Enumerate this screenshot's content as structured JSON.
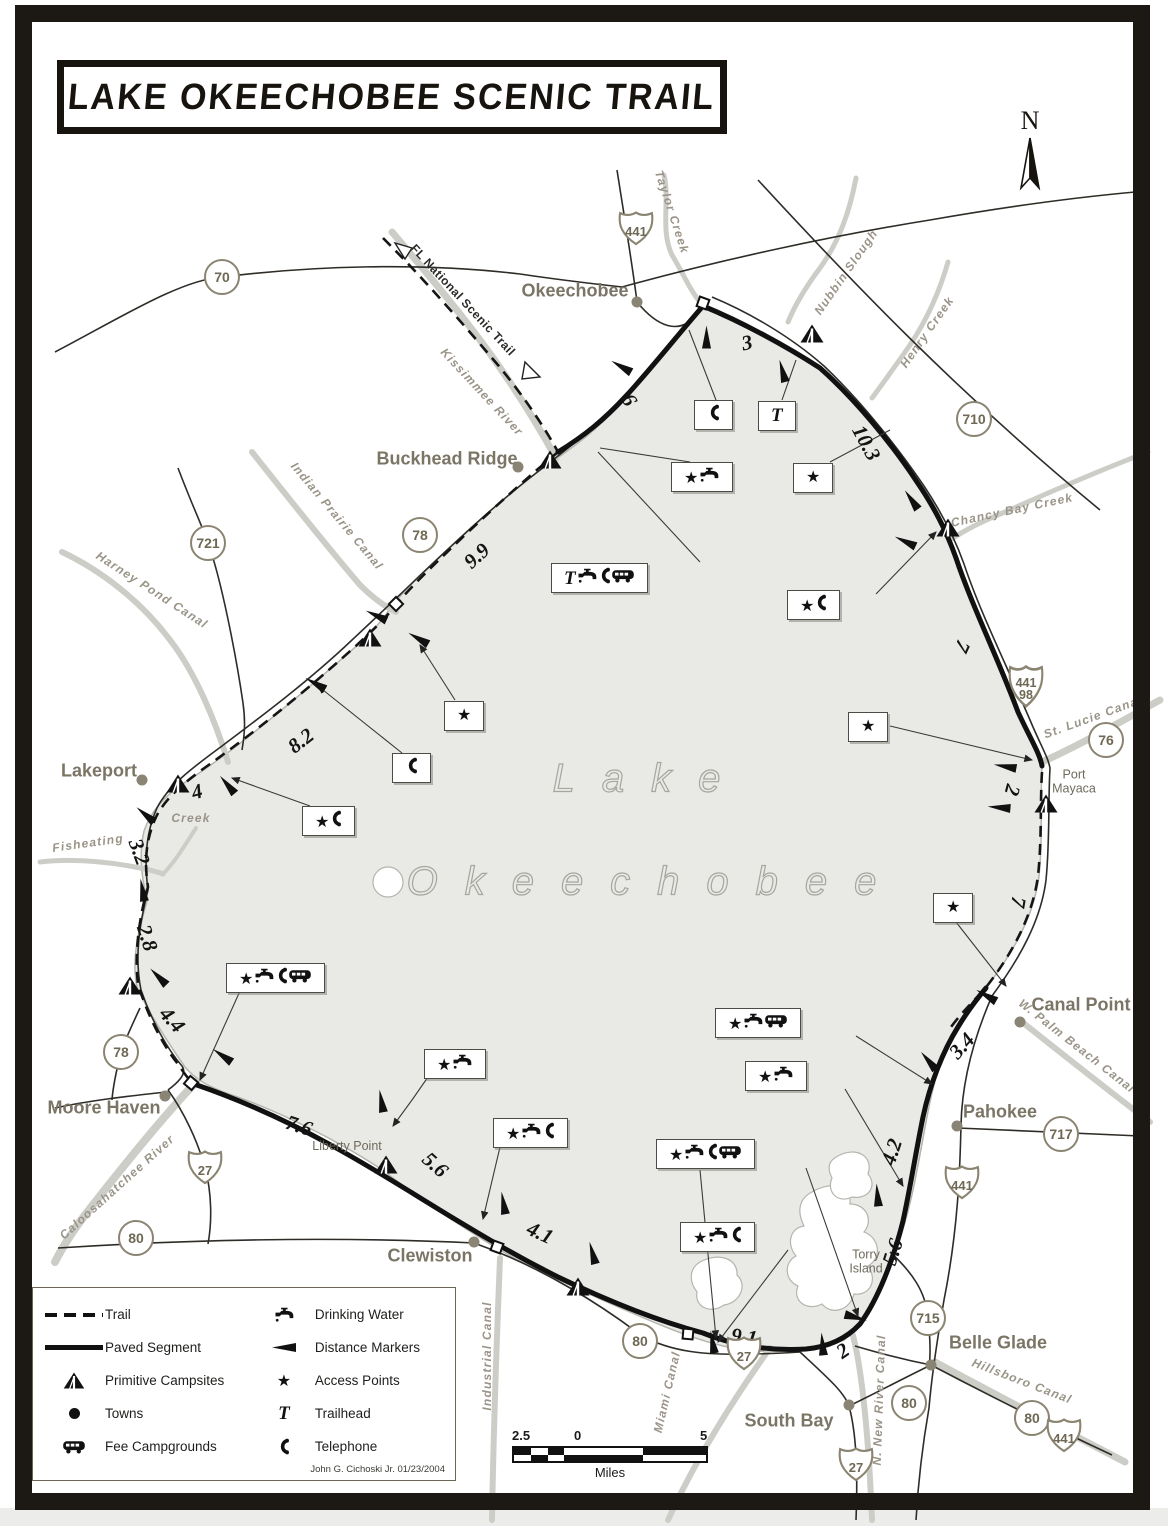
{
  "title": "LAKE OKEECHOBEE SCENIC TRAIL",
  "north": {
    "label": "N"
  },
  "lake": {
    "line1": "Lake",
    "line2": "Okeechobee"
  },
  "fnst": {
    "label": "FL National Scenic Trail"
  },
  "credit": "John G. Cichoski Jr.  01/23/2004",
  "towns": [
    {
      "name": "Okeechobee",
      "x": 575,
      "y": 291
    },
    {
      "name": "Buckhead Ridge",
      "x": 447,
      "y": 459
    },
    {
      "name": "Lakeport",
      "x": 99,
      "y": 771
    },
    {
      "name": "Moore Haven",
      "x": 104,
      "y": 1108
    },
    {
      "name": "Clewiston",
      "x": 430,
      "y": 1256
    },
    {
      "name": "South Bay",
      "x": 789,
      "y": 1421
    },
    {
      "name": "Belle Glade",
      "x": 998,
      "y": 1343
    },
    {
      "name": "Pahokee",
      "x": 1000,
      "y": 1112
    },
    {
      "name": "Canal Point",
      "x": 1081,
      "y": 1005
    }
  ],
  "town_dots": [
    {
      "x": 637,
      "y": 302
    },
    {
      "x": 518,
      "y": 467
    },
    {
      "x": 142,
      "y": 780
    },
    {
      "x": 165,
      "y": 1096
    },
    {
      "x": 474,
      "y": 1242
    },
    {
      "x": 849,
      "y": 1405
    },
    {
      "x": 931,
      "y": 1365
    },
    {
      "x": 957,
      "y": 1126
    },
    {
      "x": 1020,
      "y": 1022
    }
  ],
  "places": [
    {
      "name": "Liberty Point",
      "x": 347,
      "y": 1146
    },
    {
      "name": "Torry\nIsland",
      "x": 866,
      "y": 1262
    },
    {
      "name": "Port\nMayaca",
      "x": 1074,
      "y": 782
    }
  ],
  "circle_shields": [
    {
      "num": "70",
      "x": 222,
      "y": 277
    },
    {
      "num": "721",
      "x": 208,
      "y": 543
    },
    {
      "num": "78",
      "x": 420,
      "y": 535
    },
    {
      "num": "710",
      "x": 974,
      "y": 419
    },
    {
      "num": "76",
      "x": 1106,
      "y": 740
    },
    {
      "num": "717",
      "x": 1061,
      "y": 1134
    },
    {
      "num": "78",
      "x": 121,
      "y": 1052
    },
    {
      "num": "80",
      "x": 136,
      "y": 1238
    },
    {
      "num": "80",
      "x": 640,
      "y": 1341
    },
    {
      "num": "715",
      "x": 928,
      "y": 1318
    },
    {
      "num": "80",
      "x": 909,
      "y": 1403
    },
    {
      "num": "80",
      "x": 1032,
      "y": 1418
    }
  ],
  "us_shields": [
    {
      "num": "441",
      "x": 636,
      "y": 228
    },
    {
      "num": "441\n98",
      "x": 1026,
      "y": 686,
      "cls": "tall"
    },
    {
      "num": "27",
      "x": 205,
      "y": 1167
    },
    {
      "num": "27",
      "x": 744,
      "y": 1353
    },
    {
      "num": "27",
      "x": 856,
      "y": 1464
    },
    {
      "num": "441",
      "x": 962,
      "y": 1182
    },
    {
      "num": "441",
      "x": 1064,
      "y": 1435
    }
  ],
  "water_labels": [
    {
      "name": "Taylor Creek",
      "x": 672,
      "y": 212,
      "rot": 72
    },
    {
      "name": "Kissimmee River",
      "x": 482,
      "y": 392,
      "rot": 47
    },
    {
      "name": "Nubbin Slough",
      "x": 846,
      "y": 272,
      "rot": -55
    },
    {
      "name": "Henry Creek",
      "x": 927,
      "y": 332,
      "rot": -55
    },
    {
      "name": "Chancy Bay Creek",
      "x": 1012,
      "y": 510,
      "rot": -12
    },
    {
      "name": "St. Lucie Canal",
      "x": 1093,
      "y": 717,
      "rot": -20
    },
    {
      "name": "Indian Prairie Canal",
      "x": 337,
      "y": 516,
      "rot": 50
    },
    {
      "name": "Harney Pond Canal",
      "x": 152,
      "y": 590,
      "rot": 33
    },
    {
      "name": "Fisheating",
      "x": 88,
      "y": 843,
      "rot": -8
    },
    {
      "name": "Creek",
      "x": 191,
      "y": 818,
      "rot": 0
    },
    {
      "name": "Caloosahatchee River",
      "x": 117,
      "y": 1187,
      "rot": -42
    },
    {
      "name": "Industrial Canal",
      "x": 487,
      "y": 1356,
      "rot": -90
    },
    {
      "name": "Miami Canal",
      "x": 667,
      "y": 1392,
      "rot": -77
    },
    {
      "name": "N. New River Canal",
      "x": 879,
      "y": 1400,
      "rot": -88
    },
    {
      "name": "Hillsboro Canal",
      "x": 1022,
      "y": 1381,
      "rot": 21
    },
    {
      "name": "W. Palm Beach Canal",
      "x": 1077,
      "y": 1046,
      "rot": 38
    }
  ],
  "distances": [
    {
      "value": "3",
      "x": 747,
      "y": 343,
      "rot": -12
    },
    {
      "value": "6",
      "x": 629,
      "y": 400,
      "rot": 60
    },
    {
      "value": "10.3",
      "x": 866,
      "y": 443,
      "rot": 62
    },
    {
      "value": "9.9",
      "x": 477,
      "y": 556,
      "rot": -42
    },
    {
      "value": "7",
      "x": 962,
      "y": 646,
      "rot": 115
    },
    {
      "value": "8.2",
      "x": 301,
      "y": 741,
      "rot": -38
    },
    {
      "value": "4",
      "x": 197,
      "y": 792,
      "rot": -15
    },
    {
      "value": "3.2",
      "x": 139,
      "y": 852,
      "rot": 70
    },
    {
      "value": "2.8",
      "x": 147,
      "y": 938,
      "rot": 72
    },
    {
      "value": "4.4",
      "x": 172,
      "y": 1020,
      "rot": 48
    },
    {
      "value": "7.6",
      "x": 299,
      "y": 1126,
      "rot": 18
    },
    {
      "value": "5.6",
      "x": 435,
      "y": 1165,
      "rot": 42
    },
    {
      "value": "4.1",
      "x": 540,
      "y": 1233,
      "rot": 25
    },
    {
      "value": "9.1",
      "x": 744,
      "y": 1337,
      "rot": 8
    },
    {
      "value": "2",
      "x": 843,
      "y": 1351,
      "rot": -35
    },
    {
      "value": "5.6",
      "x": 893,
      "y": 1252,
      "rot": -72
    },
    {
      "value": "4.2",
      "x": 892,
      "y": 1152,
      "rot": -72
    },
    {
      "value": "3.4",
      "x": 962,
      "y": 1046,
      "rot": -48
    },
    {
      "value": "7",
      "x": 1018,
      "y": 902,
      "rot": 100
    },
    {
      "value": "2",
      "x": 1012,
      "y": 790,
      "rot": 105
    }
  ],
  "amenity_boxes": [
    {
      "x": 694,
      "y": 400,
      "icons": [
        "phone"
      ]
    },
    {
      "x": 758,
      "y": 401,
      "icons": [
        "trailhead"
      ]
    },
    {
      "x": 671,
      "y": 462,
      "icons": [
        "star",
        "water"
      ]
    },
    {
      "x": 793,
      "y": 463,
      "icons": [
        "star"
      ]
    },
    {
      "x": 551,
      "y": 563,
      "icons": [
        "trailhead",
        "water",
        "phone",
        "fee"
      ]
    },
    {
      "x": 787,
      "y": 590,
      "icons": [
        "star",
        "phone"
      ]
    },
    {
      "x": 444,
      "y": 701,
      "icons": [
        "star"
      ]
    },
    {
      "x": 392,
      "y": 753,
      "icons": [
        "phone"
      ]
    },
    {
      "x": 302,
      "y": 806,
      "icons": [
        "star",
        "phone"
      ]
    },
    {
      "x": 848,
      "y": 712,
      "icons": [
        "star"
      ]
    },
    {
      "x": 933,
      "y": 893,
      "icons": [
        "star"
      ]
    },
    {
      "x": 226,
      "y": 963,
      "icons": [
        "star",
        "water",
        "phone",
        "fee"
      ]
    },
    {
      "x": 715,
      "y": 1008,
      "icons": [
        "star",
        "water",
        "fee"
      ]
    },
    {
      "x": 745,
      "y": 1061,
      "icons": [
        "star",
        "water"
      ]
    },
    {
      "x": 424,
      "y": 1049,
      "icons": [
        "star",
        "water"
      ]
    },
    {
      "x": 493,
      "y": 1118,
      "icons": [
        "star",
        "water",
        "phone"
      ]
    },
    {
      "x": 656,
      "y": 1139,
      "icons": [
        "star",
        "water",
        "phone",
        "fee"
      ]
    },
    {
      "x": 680,
      "y": 1222,
      "icons": [
        "star",
        "water",
        "phone"
      ]
    }
  ],
  "campsites": [
    {
      "x": 812,
      "y": 336
    },
    {
      "x": 550,
      "y": 462
    },
    {
      "x": 370,
      "y": 640
    },
    {
      "x": 178,
      "y": 786
    },
    {
      "x": 130,
      "y": 988
    },
    {
      "x": 948,
      "y": 530
    },
    {
      "x": 1046,
      "y": 806
    },
    {
      "x": 386,
      "y": 1167
    },
    {
      "x": 578,
      "y": 1289
    }
  ],
  "markers": [
    {
      "x": 706,
      "y": 337,
      "rot": 90
    },
    {
      "x": 782,
      "y": 371,
      "rot": 75
    },
    {
      "x": 621,
      "y": 367,
      "rot": 30
    },
    {
      "x": 911,
      "y": 500,
      "rot": 55
    },
    {
      "x": 376,
      "y": 616,
      "rot": 25
    },
    {
      "x": 418,
      "y": 639,
      "rot": 30
    },
    {
      "x": 315,
      "y": 684,
      "rot": 30
    },
    {
      "x": 227,
      "y": 785,
      "rot": 50
    },
    {
      "x": 145,
      "y": 815,
      "rot": 40
    },
    {
      "x": 142,
      "y": 890,
      "rot": 80
    },
    {
      "x": 158,
      "y": 977,
      "rot": 45
    },
    {
      "x": 222,
      "y": 1056,
      "rot": 35
    },
    {
      "x": 381,
      "y": 1101,
      "rot": 80
    },
    {
      "x": 503,
      "y": 1203,
      "rot": 80
    },
    {
      "x": 592,
      "y": 1253,
      "rot": 75
    },
    {
      "x": 822,
      "y": 1344,
      "rot": 85
    },
    {
      "x": 856,
      "y": 1317,
      "rot": 195
    },
    {
      "x": 928,
      "y": 1061,
      "rot": 50
    },
    {
      "x": 877,
      "y": 1195,
      "rot": 85
    },
    {
      "x": 1005,
      "y": 767,
      "rot": 10
    },
    {
      "x": 999,
      "y": 808,
      "rot": 5
    },
    {
      "x": 986,
      "y": 996,
      "rot": 30
    },
    {
      "x": 905,
      "y": 542,
      "rot": 25
    },
    {
      "x": 712,
      "y": 1342,
      "rot": 80
    }
  ],
  "legend": {
    "left": [
      {
        "icon": "trail-dash",
        "label": "Trail"
      },
      {
        "icon": "paved",
        "label": "Paved Segment"
      },
      {
        "icon": "tent",
        "label": "Primitive Campsites"
      },
      {
        "icon": "dot",
        "label": "Towns"
      },
      {
        "icon": "fee",
        "label": "Fee Campgrounds"
      }
    ],
    "right": [
      {
        "icon": "water",
        "label": "Drinking Water"
      },
      {
        "icon": "marker",
        "label": "Distance Markers"
      },
      {
        "icon": "star",
        "label": "Access Points"
      },
      {
        "icon": "trailhead",
        "label": "Trailhead"
      },
      {
        "icon": "phone",
        "label": "Telephone"
      }
    ]
  },
  "scale": {
    "left": "2.5",
    "zero": "0",
    "right": "5",
    "unit": "Miles"
  }
}
